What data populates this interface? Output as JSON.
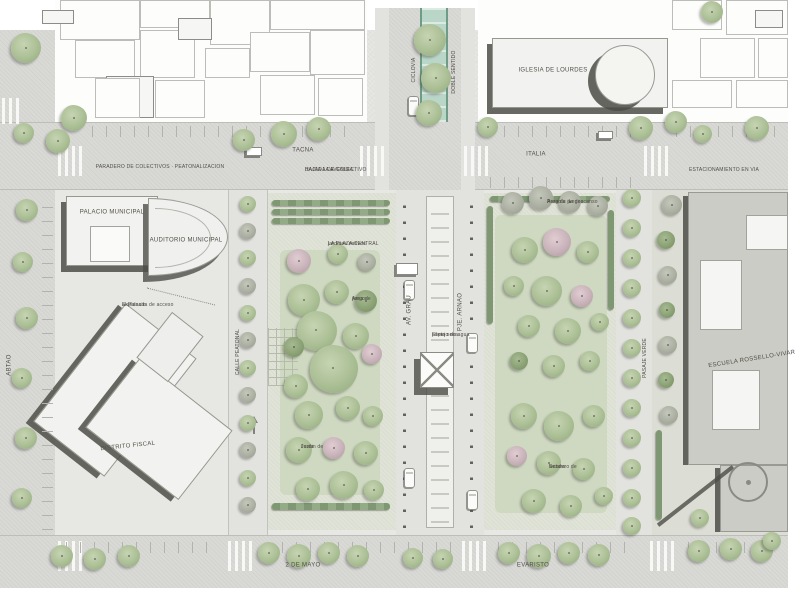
{
  "buildings": {
    "palacio": "PALACIO MUNICIPAL",
    "auditorio": "AUDITORIO MUNICIPAL",
    "distrito_fiscal": "DISTRITO FISCAL",
    "iglesia": "IGLESIA DE LOURDES",
    "escuela": "ESCUELA ROSSELLO-VIVAR"
  },
  "streets": {
    "top_note_left": "PARADERO DE COLECTIVOS  ·  PEATONALIZACION",
    "top_name_center": "TACNA",
    "top_note_center_1": "BAJADA DE COLECTIVO",
    "top_note_center_2": "HACIA LA AVENIDA",
    "top_name_right": "ITALIA",
    "top_note_right": "ESTACIONAMIENTO EN VIA",
    "bottom_name_left": "2 DE MAYO",
    "bottom_name_right": "EVARISTO",
    "left_vertical": "ABTAO",
    "boulevard_left": "AV. GRAU",
    "boulevard_right": "PJE. ARNAO",
    "pedestrian": "CALLE PEATONAL",
    "alley_right": "PASAJE VERDE",
    "ciclovia_1": "CICLOVIA",
    "ciclovia_2": "DOBLE SENTIDO"
  },
  "park_labels": {
    "left_title_1": "LA PLAZA CENTRAL",
    "left_title_2": "jardines nativos",
    "left_small_1a": "Area de",
    "left_small_1b": "juegos",
    "left_small_2a": "Jardin de",
    "left_small_2b": "lluvia",
    "right_title_1": "Pergola de descanso",
    "right_title_2": "Area de juegos",
    "right_small_1a": "Sendero de",
    "right_small_1b": "lectura",
    "center_small_1": "Espejo de agua",
    "center_small_2": "pileta seca",
    "explanada_1": "Explanada de acceso",
    "explanada_2": "al Palacio"
  },
  "colors": {
    "ciclovia": "#b9d6c9",
    "tree_green": "#abbf95",
    "tree_blossom": "#c9b3ba",
    "hedge": "#7f9873",
    "shadow": "rgba(78,78,72,0.85)",
    "street": "#d9d9d6",
    "park": "#e0e3d7"
  },
  "features": {
    "trees": [
      [
        26,
        48,
        15,
        "g"
      ],
      [
        74,
        118,
        13,
        "g"
      ],
      [
        58,
        141,
        12,
        "g"
      ],
      [
        24,
        133,
        10,
        "g"
      ],
      [
        244,
        140,
        11,
        "g"
      ],
      [
        284,
        134,
        13,
        "g"
      ],
      [
        319,
        129,
        12,
        "g"
      ],
      [
        430,
        40,
        16,
        "g"
      ],
      [
        436,
        78,
        15,
        "g"
      ],
      [
        429,
        113,
        13,
        "g"
      ],
      [
        488,
        127,
        10,
        "g"
      ],
      [
        641,
        128,
        12,
        "g"
      ],
      [
        676,
        122,
        11,
        "g"
      ],
      [
        703,
        134,
        9,
        "g"
      ],
      [
        757,
        128,
        12,
        "g"
      ],
      [
        712,
        12,
        11,
        "g"
      ],
      [
        27,
        210,
        11,
        "g"
      ],
      [
        23,
        262,
        10,
        "g"
      ],
      [
        27,
        318,
        11,
        "g"
      ],
      [
        22,
        378,
        10,
        "g"
      ],
      [
        26,
        438,
        11,
        "g"
      ],
      [
        22,
        498,
        10,
        "g"
      ],
      [
        62,
        556,
        11,
        "g"
      ],
      [
        95,
        559,
        11,
        "g"
      ],
      [
        129,
        556,
        11,
        "g"
      ],
      [
        269,
        553,
        11,
        "g"
      ],
      [
        299,
        556,
        12,
        "g"
      ],
      [
        329,
        553,
        11,
        "g"
      ],
      [
        358,
        556,
        11,
        "g"
      ],
      [
        413,
        558,
        10,
        "g"
      ],
      [
        443,
        559,
        10,
        "g"
      ],
      [
        509,
        553,
        11,
        "g"
      ],
      [
        539,
        556,
        12,
        "g"
      ],
      [
        569,
        553,
        11,
        "g"
      ],
      [
        599,
        555,
        11,
        "g"
      ],
      [
        699,
        551,
        11,
        "g"
      ],
      [
        731,
        549,
        11,
        "g"
      ],
      [
        762,
        551,
        11,
        "g"
      ],
      [
        248,
        204,
        8,
        "g"
      ],
      [
        248,
        231,
        8,
        "x"
      ],
      [
        248,
        258,
        8,
        "g"
      ],
      [
        248,
        286,
        8,
        "x"
      ],
      [
        248,
        313,
        8,
        "g"
      ],
      [
        248,
        340,
        8,
        "x"
      ],
      [
        248,
        368,
        8,
        "g"
      ],
      [
        248,
        395,
        8,
        "x"
      ],
      [
        248,
        423,
        8,
        "g"
      ],
      [
        248,
        450,
        8,
        "x"
      ],
      [
        248,
        478,
        8,
        "g"
      ],
      [
        248,
        505,
        8,
        "x"
      ],
      [
        632,
        198,
        9,
        "g"
      ],
      [
        632,
        228,
        9,
        "g"
      ],
      [
        632,
        258,
        9,
        "g"
      ],
      [
        632,
        288,
        9,
        "g"
      ],
      [
        632,
        318,
        9,
        "g"
      ],
      [
        632,
        348,
        9,
        "g"
      ],
      [
        632,
        378,
        9,
        "g"
      ],
      [
        632,
        408,
        9,
        "g"
      ],
      [
        632,
        438,
        9,
        "g"
      ],
      [
        632,
        468,
        9,
        "g"
      ],
      [
        632,
        498,
        9,
        "g"
      ],
      [
        632,
        526,
        9,
        "g"
      ],
      [
        299,
        261,
        12,
        "p"
      ],
      [
        338,
        254,
        10,
        "g"
      ],
      [
        367,
        262,
        9,
        "x"
      ],
      [
        304,
        300,
        16,
        "g"
      ],
      [
        337,
        292,
        12,
        "g"
      ],
      [
        366,
        301,
        11,
        "d"
      ],
      [
        317,
        331,
        20,
        "g"
      ],
      [
        356,
        336,
        13,
        "g"
      ],
      [
        294,
        347,
        10,
        "d"
      ],
      [
        334,
        369,
        24,
        "g"
      ],
      [
        372,
        354,
        10,
        "p"
      ],
      [
        296,
        386,
        12,
        "g"
      ],
      [
        309,
        415,
        14,
        "g"
      ],
      [
        348,
        408,
        12,
        "g"
      ],
      [
        373,
        416,
        10,
        "g"
      ],
      [
        299,
        450,
        13,
        "g"
      ],
      [
        334,
        448,
        11,
        "p"
      ],
      [
        366,
        453,
        12,
        "g"
      ],
      [
        308,
        489,
        12,
        "g"
      ],
      [
        344,
        485,
        14,
        "g"
      ],
      [
        374,
        490,
        10,
        "g"
      ],
      [
        513,
        203,
        11,
        "x"
      ],
      [
        541,
        198,
        12,
        "x"
      ],
      [
        570,
        202,
        11,
        "x"
      ],
      [
        598,
        206,
        10,
        "x"
      ],
      [
        525,
        250,
        13,
        "g"
      ],
      [
        557,
        242,
        14,
        "p"
      ],
      [
        588,
        252,
        11,
        "g"
      ],
      [
        514,
        286,
        10,
        "g"
      ],
      [
        547,
        291,
        15,
        "g"
      ],
      [
        582,
        296,
        11,
        "p"
      ],
      [
        529,
        326,
        11,
        "g"
      ],
      [
        568,
        331,
        13,
        "g"
      ],
      [
        600,
        322,
        9,
        "g"
      ],
      [
        519,
        361,
        9,
        "d"
      ],
      [
        554,
        366,
        11,
        "g"
      ],
      [
        590,
        361,
        10,
        "g"
      ],
      [
        524,
        416,
        13,
        "g"
      ],
      [
        559,
        426,
        15,
        "g"
      ],
      [
        594,
        416,
        11,
        "g"
      ],
      [
        517,
        456,
        10,
        "p"
      ],
      [
        549,
        463,
        12,
        "g"
      ],
      [
        584,
        469,
        11,
        "g"
      ],
      [
        534,
        501,
        12,
        "g"
      ],
      [
        571,
        506,
        11,
        "g"
      ],
      [
        604,
        496,
        9,
        "g"
      ],
      [
        672,
        205,
        10,
        "x"
      ],
      [
        666,
        240,
        9,
        "d"
      ],
      [
        668,
        275,
        9,
        "x"
      ],
      [
        667,
        310,
        8,
        "d"
      ],
      [
        668,
        345,
        9,
        "x"
      ],
      [
        666,
        380,
        8,
        "d"
      ],
      [
        669,
        415,
        9,
        "x"
      ],
      [
        700,
        518,
        9,
        "g"
      ],
      [
        772,
        541,
        9,
        "g"
      ]
    ],
    "hedges": [
      [
        272,
        200,
        118,
        6
      ],
      [
        272,
        209,
        118,
        6
      ],
      [
        272,
        218,
        118,
        6
      ],
      [
        272,
        503,
        118,
        7
      ],
      [
        490,
        196,
        120,
        6
      ],
      [
        487,
        206,
        6,
        118
      ],
      [
        608,
        210,
        6,
        100
      ],
      [
        656,
        430,
        6,
        90
      ]
    ],
    "context_buildings": [
      [
        60,
        0,
        80,
        40,
        0
      ],
      [
        140,
        0,
        70,
        28,
        0
      ],
      [
        210,
        0,
        60,
        45,
        0
      ],
      [
        270,
        0,
        95,
        30,
        0
      ],
      [
        75,
        40,
        60,
        38,
        0
      ],
      [
        140,
        30,
        55,
        48,
        0
      ],
      [
        250,
        32,
        60,
        40,
        0
      ],
      [
        310,
        30,
        55,
        45,
        0
      ],
      [
        42,
        10,
        32,
        14,
        1
      ],
      [
        106,
        76,
        48,
        42,
        1
      ],
      [
        178,
        18,
        34,
        22,
        1
      ],
      [
        95,
        78,
        45,
        40,
        0
      ],
      [
        155,
        80,
        50,
        38,
        0
      ],
      [
        205,
        48,
        45,
        30,
        0
      ],
      [
        260,
        75,
        55,
        40,
        0
      ],
      [
        318,
        78,
        45,
        38,
        0
      ],
      [
        672,
        0,
        50,
        30,
        0
      ],
      [
        726,
        0,
        62,
        35,
        0
      ],
      [
        700,
        38,
        55,
        40,
        0
      ],
      [
        758,
        38,
        30,
        40,
        0
      ],
      [
        672,
        80,
        60,
        28,
        0
      ],
      [
        736,
        80,
        52,
        28,
        0
      ],
      [
        755,
        10,
        28,
        18,
        1
      ]
    ],
    "crosswalks": [
      [
        2,
        98,
        20,
        26,
        "v"
      ],
      [
        58,
        146,
        26,
        30,
        "v"
      ],
      [
        360,
        146,
        24,
        30,
        "v"
      ],
      [
        464,
        146,
        24,
        30,
        "v"
      ],
      [
        644,
        146,
        26,
        30,
        "v"
      ],
      [
        58,
        541,
        26,
        30,
        "v"
      ],
      [
        228,
        541,
        24,
        30,
        "v"
      ],
      [
        462,
        541,
        24,
        30,
        "v"
      ],
      [
        650,
        541,
        26,
        30,
        "v"
      ]
    ],
    "tick_strips": [
      [
        92,
        126,
        260,
        11,
        "v"
      ],
      [
        490,
        126,
        146,
        11,
        "v"
      ],
      [
        676,
        126,
        104,
        11,
        "v"
      ],
      [
        490,
        177,
        146,
        11,
        "v"
      ],
      [
        66,
        542,
        150,
        11,
        "v"
      ],
      [
        268,
        542,
        184,
        11,
        "v"
      ],
      [
        498,
        542,
        132,
        11,
        "v"
      ],
      [
        688,
        542,
        92,
        11,
        "v"
      ],
      [
        42,
        200,
        11,
        330,
        "h"
      ]
    ],
    "cars": [
      [
        404,
        280,
        11,
        20
      ],
      [
        467,
        333,
        11,
        20
      ],
      [
        404,
        468,
        11,
        20
      ],
      [
        467,
        490,
        11,
        20
      ],
      [
        408,
        96,
        11,
        20
      ]
    ],
    "kiosks": [
      [
        396,
        263,
        22,
        12
      ],
      [
        246,
        147,
        16,
        9
      ],
      [
        598,
        131,
        15,
        8
      ]
    ]
  }
}
